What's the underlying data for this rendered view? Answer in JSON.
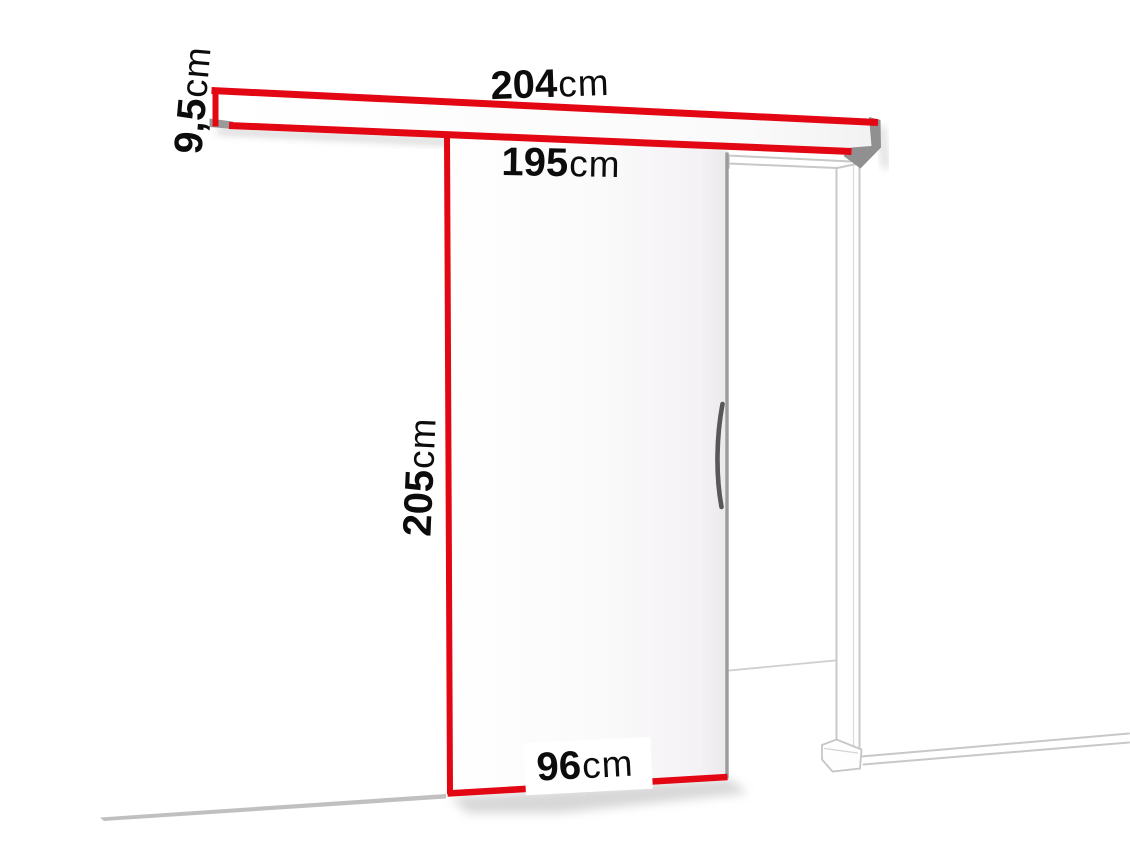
{
  "labels": {
    "rail_width": {
      "value": "204",
      "unit": "cm"
    },
    "rail_height": {
      "value": "9,5",
      "unit": "cm"
    },
    "opening_height": {
      "value": "195",
      "unit": "cm"
    },
    "door_height": {
      "value": "205",
      "unit": "cm"
    },
    "door_width": {
      "value": "96",
      "unit": "cm"
    }
  },
  "colors": {
    "dimension_red": "#e30613",
    "frame_outline_gray": "#c8c8c8",
    "rail_cap_gray": "#909090",
    "door_edge_gray": "#9b9b9b",
    "handle_gray": "#585858",
    "text_black": "#0c0c0c",
    "background": "#ffffff"
  }
}
